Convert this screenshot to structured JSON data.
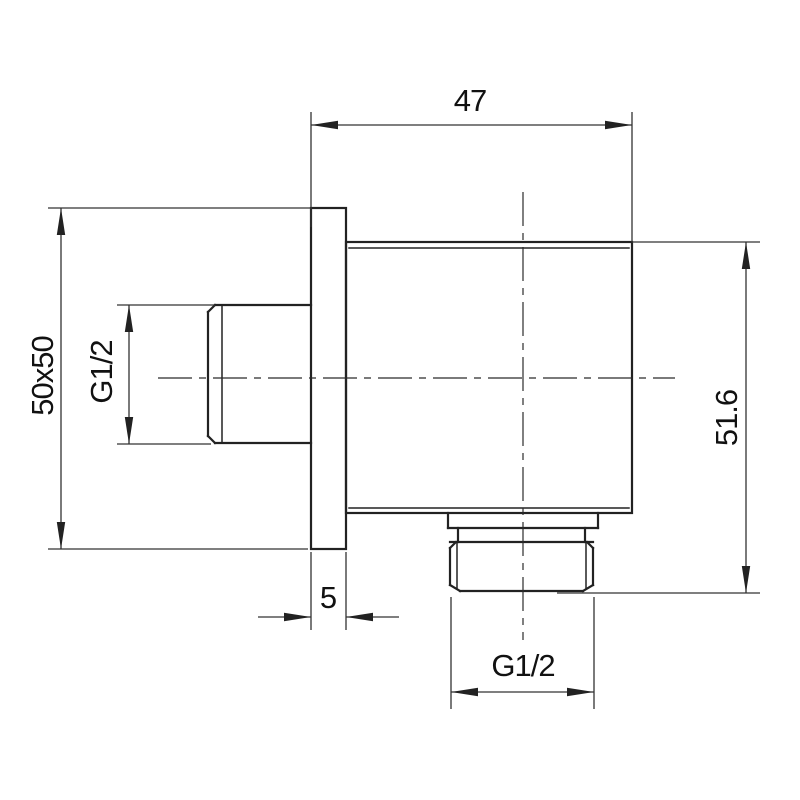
{
  "drawing": {
    "kind": "technical-dimension-drawing",
    "subject": "wall-mounted shower outlet elbow, side view",
    "colors": {
      "background": "#ffffff",
      "object_line": "#222222",
      "dimension_line": "#333333",
      "text": "#111111"
    },
    "labels": {
      "top_width": "47",
      "plate_size": "50x50",
      "inlet_thread": "G1/2",
      "plate_thickness": "5",
      "outlet_thread": "G1/2",
      "side_height": "51.6"
    }
  }
}
